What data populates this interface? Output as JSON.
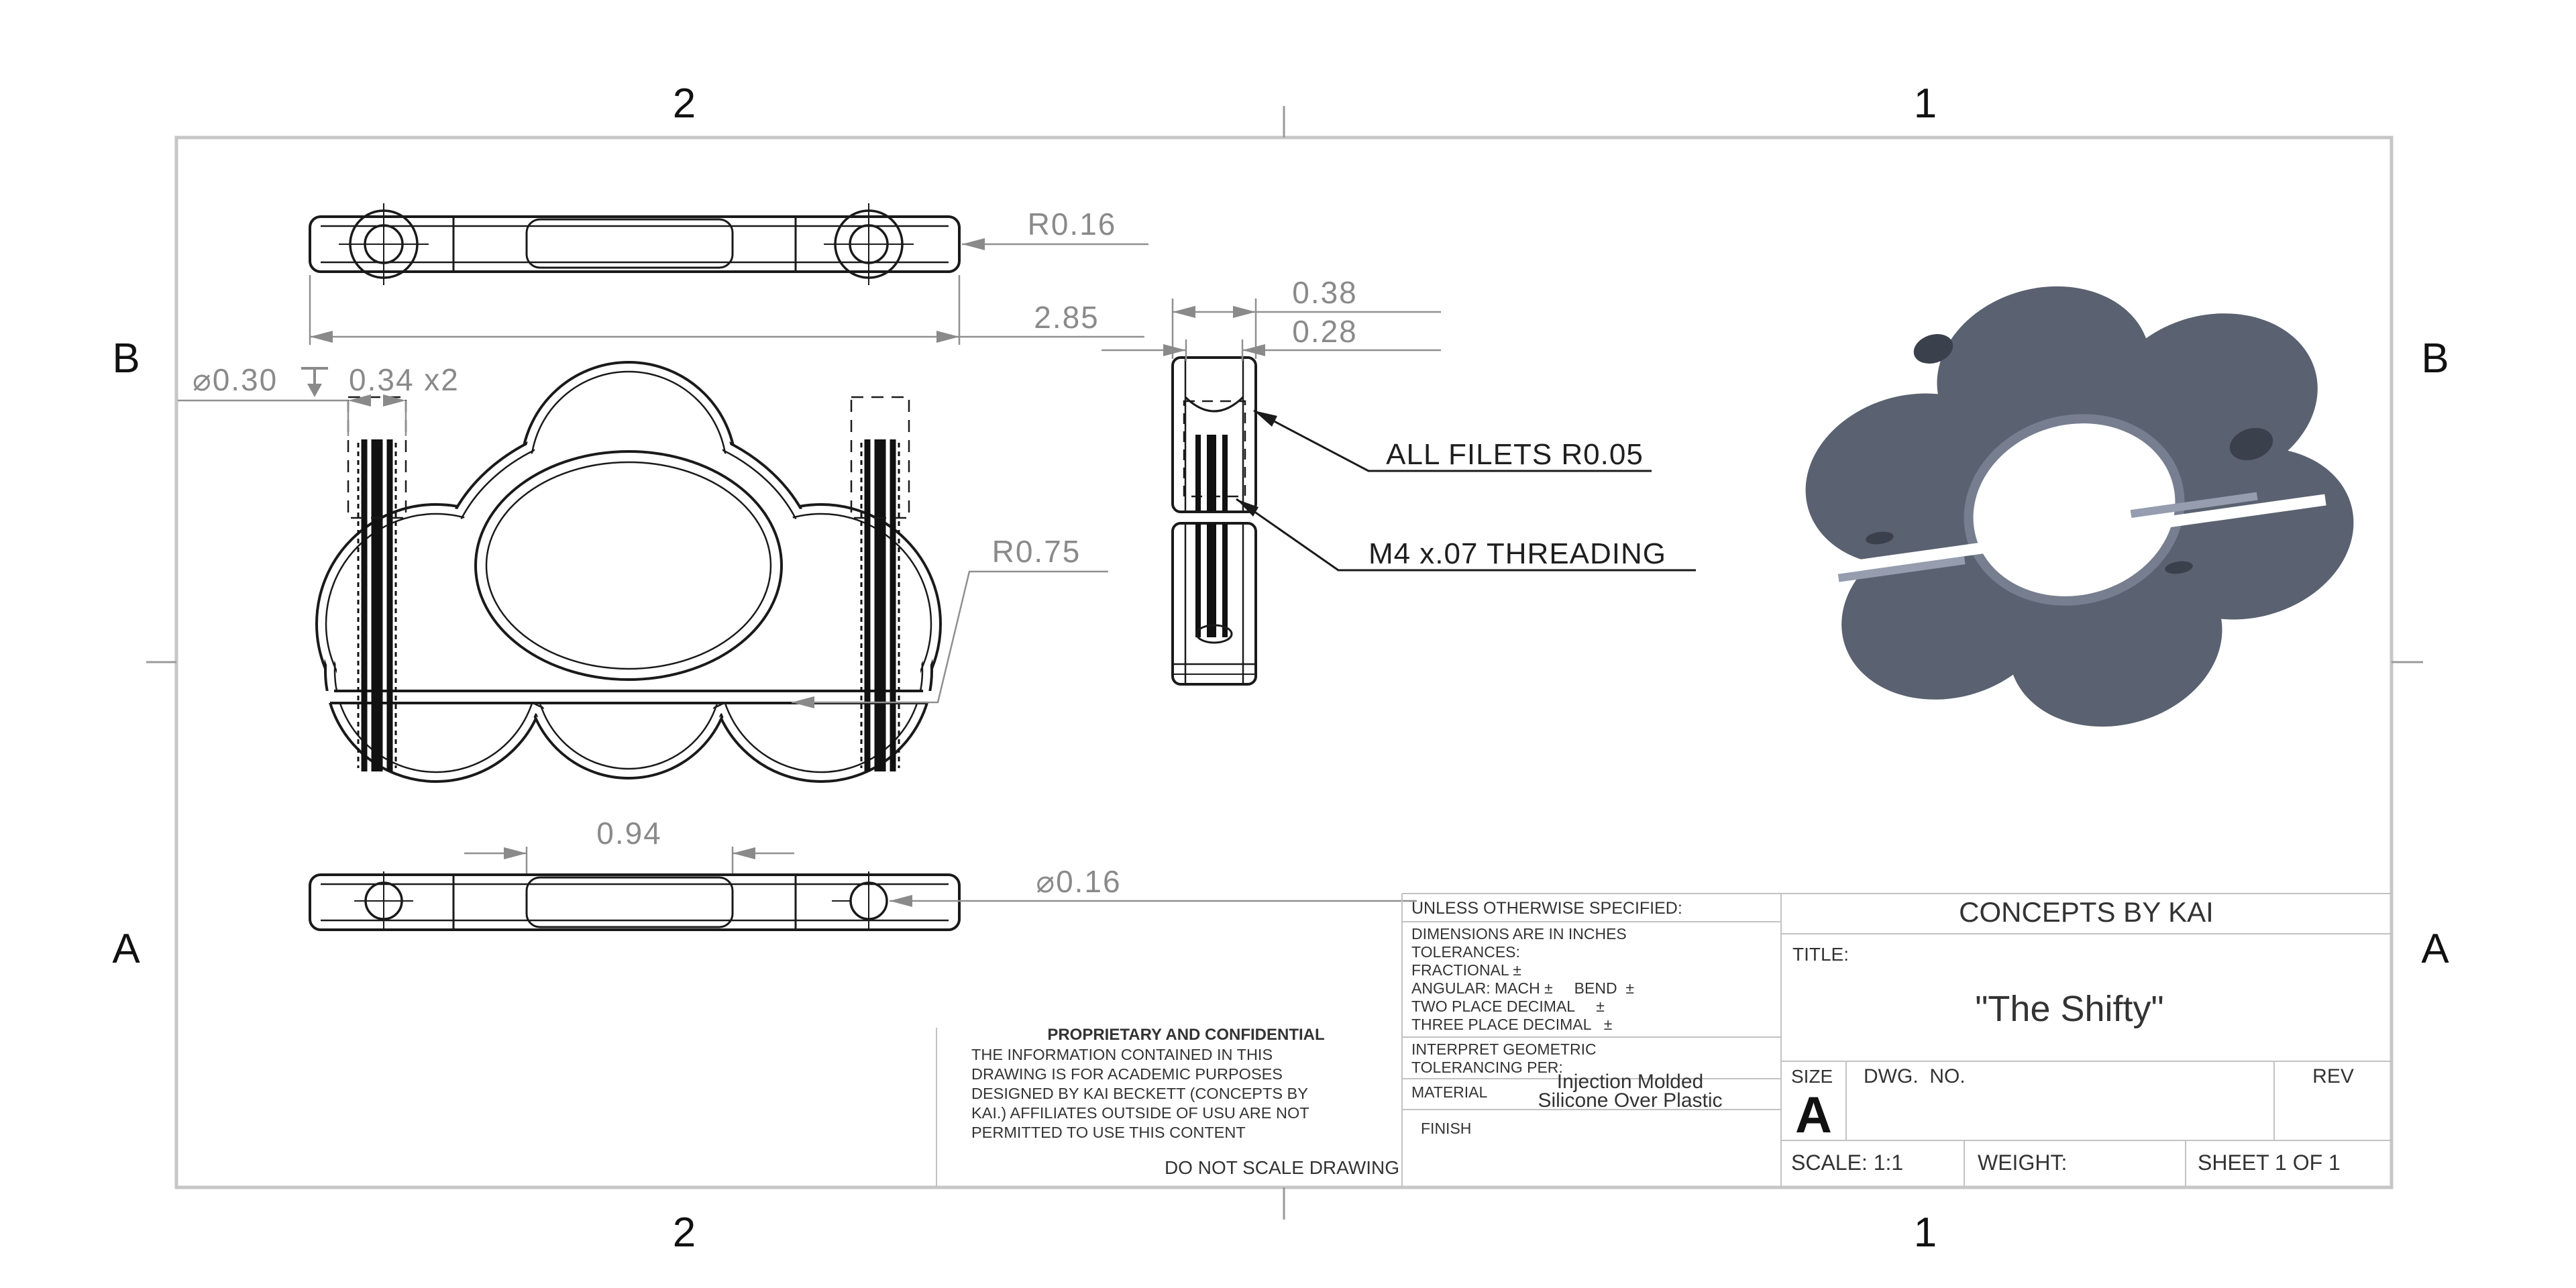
{
  "colors": {
    "drawing_line": "#1a1a1a",
    "dimension": "#8a8a8a",
    "sheet_border": "#c6c6c6",
    "iso_body": "#5a6170",
    "iso_light": "#8a93a5",
    "iso_dark": "#3a414d"
  },
  "zones": {
    "top": [
      "2",
      "1"
    ],
    "bottom": [
      "2",
      "1"
    ],
    "left": [
      "B",
      "A"
    ],
    "right": [
      "B",
      "A"
    ]
  },
  "dims": {
    "corner_radius": "R0.16",
    "bar_length": "2.85",
    "cbore_dia": "⌀0.30",
    "cbore_depth": "0.34 x2",
    "bore_radius": "R0.75",
    "side_width": "0.38",
    "side_inner_width": "0.28",
    "mid_length": "0.94",
    "hole_dia": "⌀0.16"
  },
  "notes": {
    "fillets": "ALL FILETS R0.05",
    "threading": "M4 x.07 THREADING"
  },
  "title_block": {
    "company": "CONCEPTS BY KAI",
    "title_label": "TITLE:",
    "title": "\"The Shifty\"",
    "unless": "UNLESS OTHERWISE SPECIFIED:",
    "tolerances": [
      "DIMENSIONS ARE IN INCHES",
      "TOLERANCES:",
      "FRACTIONAL ±",
      "ANGULAR: MACH ±     BEND  ±",
      "TWO PLACE DECIMAL     ±",
      "THREE PLACE DECIMAL   ±"
    ],
    "interpret": [
      "INTERPRET GEOMETRIC",
      "TOLERANCING PER:"
    ],
    "material_label": "MATERIAL",
    "material_value_1": "Injection Molded",
    "material_value_2": "Silicone Over Plastic",
    "finish_label": "FINISH",
    "size_label": "SIZE",
    "size": "A",
    "dwg_label": "DWG.  NO.",
    "rev_label": "REV",
    "scale": "SCALE: 1:1",
    "weight_label": "WEIGHT:",
    "sheet_label": "SHEET 1 OF 1",
    "do_not_scale": "DO NOT SCALE DRAWING"
  },
  "proprietary": {
    "heading": "PROPRIETARY AND CONFIDENTIAL",
    "lines": [
      "THE INFORMATION CONTAINED IN THIS",
      "DRAWING IS FOR ACADEMIC PURPOSES",
      "DESIGNED BY KAI BECKETT (CONCEPTS BY",
      "KAI.) AFFILIATES OUTSIDE OF USU ARE NOT",
      "PERMITTED TO USE THIS CONTENT"
    ]
  }
}
